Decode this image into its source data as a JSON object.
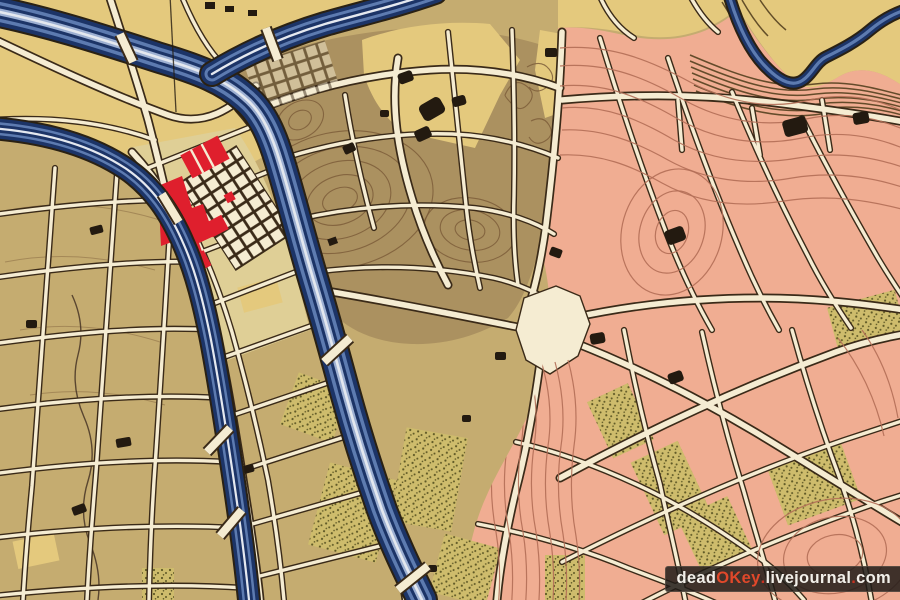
{
  "map": {
    "kind": "scanned historic city plan fragment",
    "visible_text_other_than_watermark": ""
  },
  "palette": {
    "tan": "#c5ac70",
    "yellow": "#e4c97d",
    "olive": "#ab9160",
    "pink": "#f0ad92",
    "island": "#dfcf96",
    "park_fill": "#cebc6c",
    "park_dot": "#5f5926",
    "street_fill": "#f5ecd2",
    "street_edge": "#3a2a18",
    "contour": "#7c5d39",
    "contour_pink": "#b26e56",
    "hatch": "#54401f",
    "water_dark": "#1c3467",
    "water_mid": "#5d7bb0",
    "water_pale": "#9db0d2",
    "building_red": "#df1f2d",
    "building_black": "#231a10"
  },
  "watermark": {
    "background": "rgba(32,27,24,0.85)",
    "parts": [
      {
        "text": "dead",
        "color": "#f2efe9"
      },
      {
        "text": "OKey",
        "color": "#e0482a"
      },
      {
        "text": ".",
        "color": "#c83222"
      },
      {
        "text": "livejournal",
        "color": "#f2efe9"
      },
      {
        "text": ".",
        "color": "#c83222"
      },
      {
        "text": "com",
        "color": "#f2efe9"
      }
    ]
  }
}
